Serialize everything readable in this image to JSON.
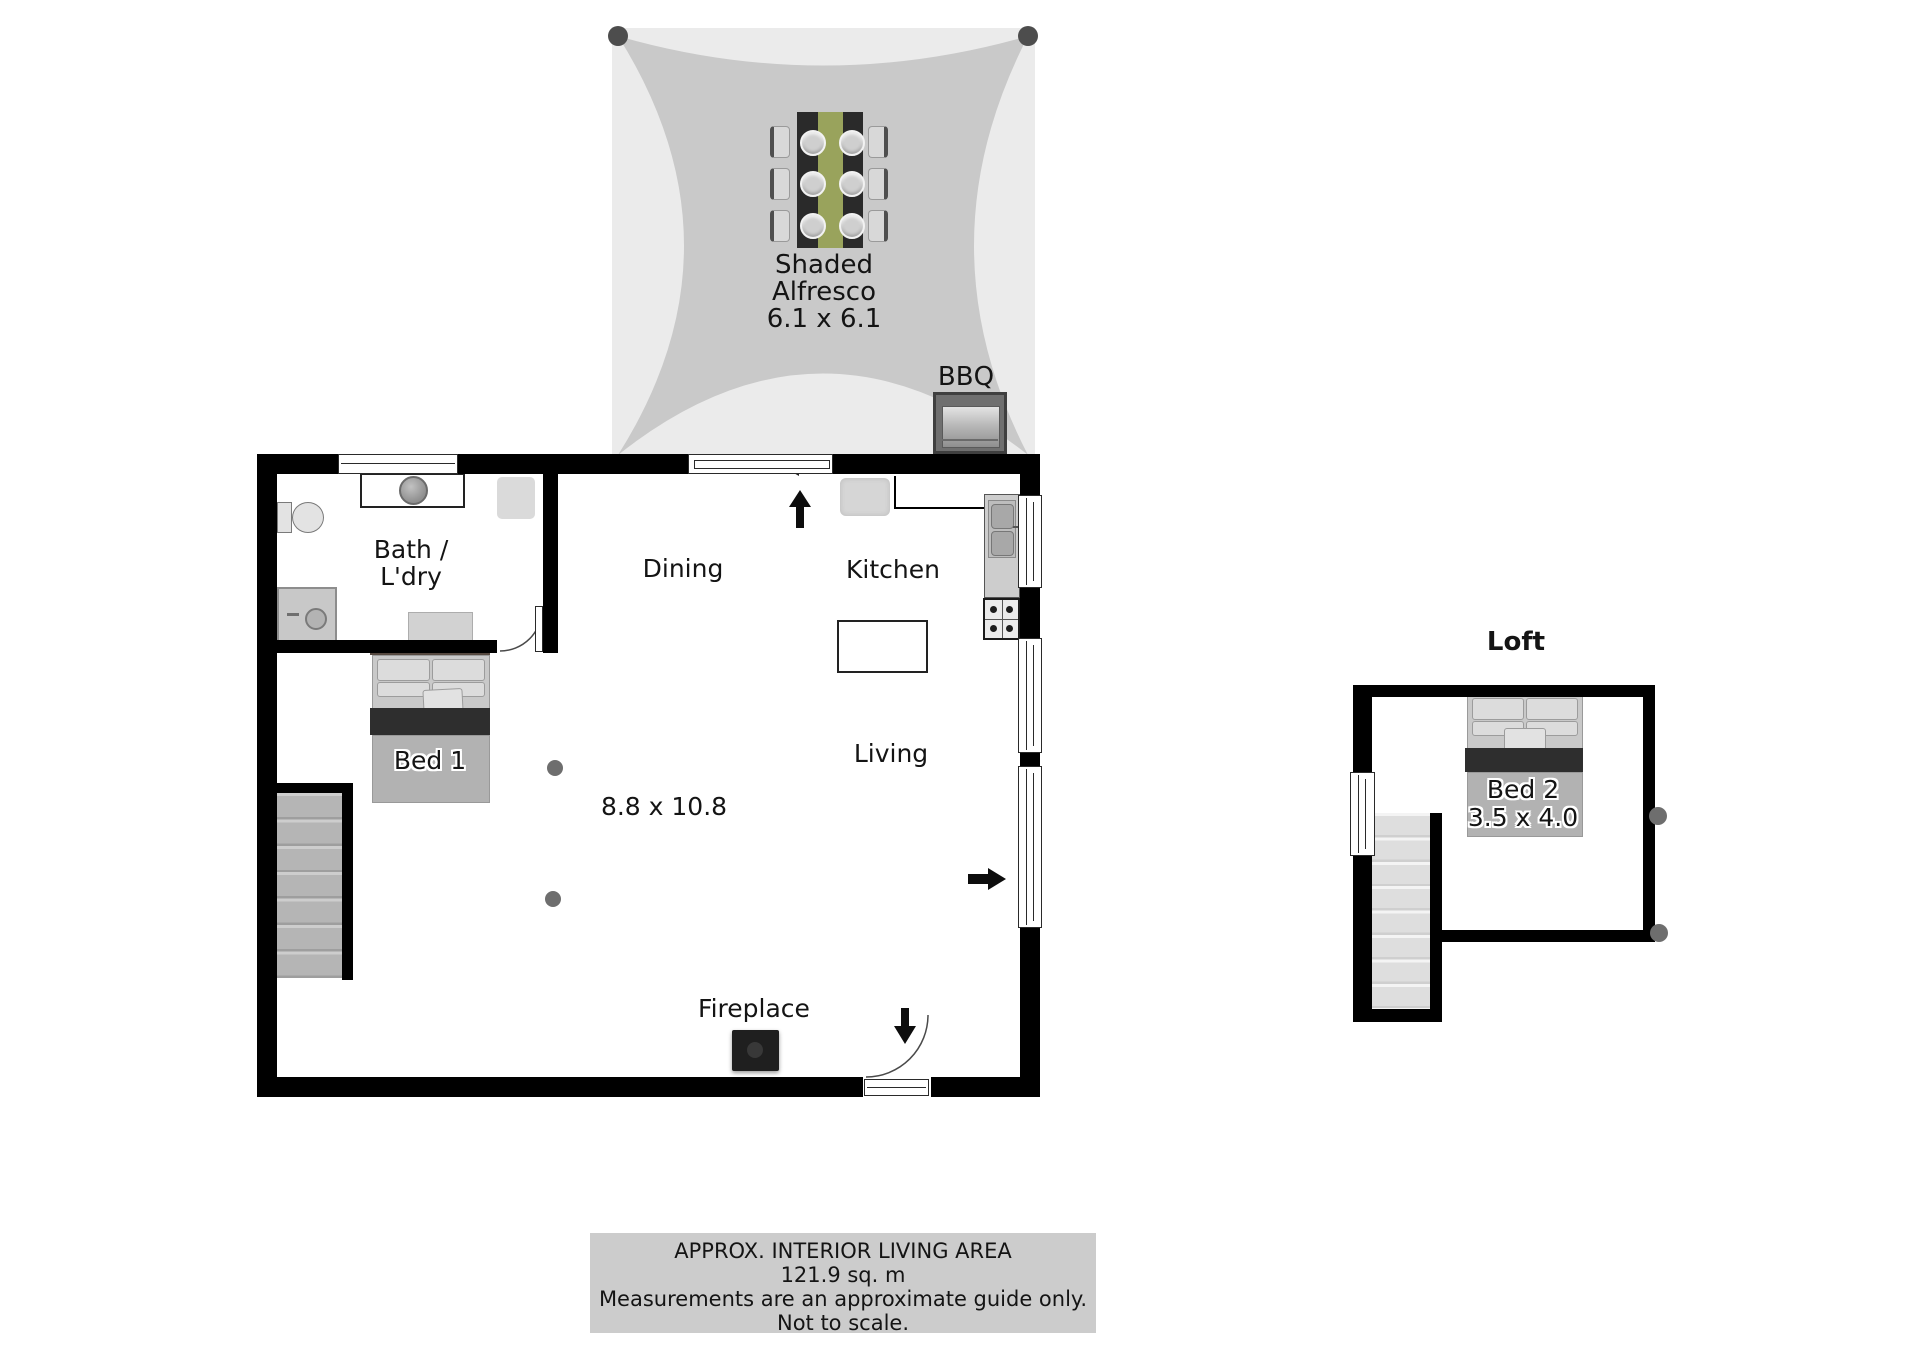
{
  "floorplan": {
    "alfresco": {
      "line1": "Shaded",
      "line2": "Alfresco",
      "dimensions": "6.1 x 6.1",
      "bbq_label": "BBQ"
    },
    "rooms": {
      "bath_laundry": {
        "line1": "Bath /",
        "line2": "L'dry"
      },
      "dining": {
        "label": "Dining"
      },
      "kitchen": {
        "label": "Kitchen"
      },
      "living": {
        "label": "Living",
        "dimensions": "8.8 x 10.8"
      },
      "bed1": {
        "label": "Bed 1"
      },
      "fireplace": {
        "label": "Fireplace"
      }
    },
    "loft": {
      "title": "Loft",
      "bed2_label": "Bed 2",
      "bed2_dimensions": "3.5 x 4.0"
    },
    "footer": {
      "line1": "APPROX. INTERIOR LIVING AREA",
      "line2": "121.9 sq. m",
      "line3": "Measurements are an approximate guide only.",
      "line4": "Not to scale."
    },
    "colors": {
      "wall": "#000000",
      "shade_sail": "#c9c9c9",
      "shade_sail_background": "#ebebeb",
      "table_runner_green": "#99a35c",
      "footer_background": "#cccccc",
      "stairs_gray": "#b9b9b9",
      "bed_blanket_dark": "#2e2e2e"
    }
  }
}
